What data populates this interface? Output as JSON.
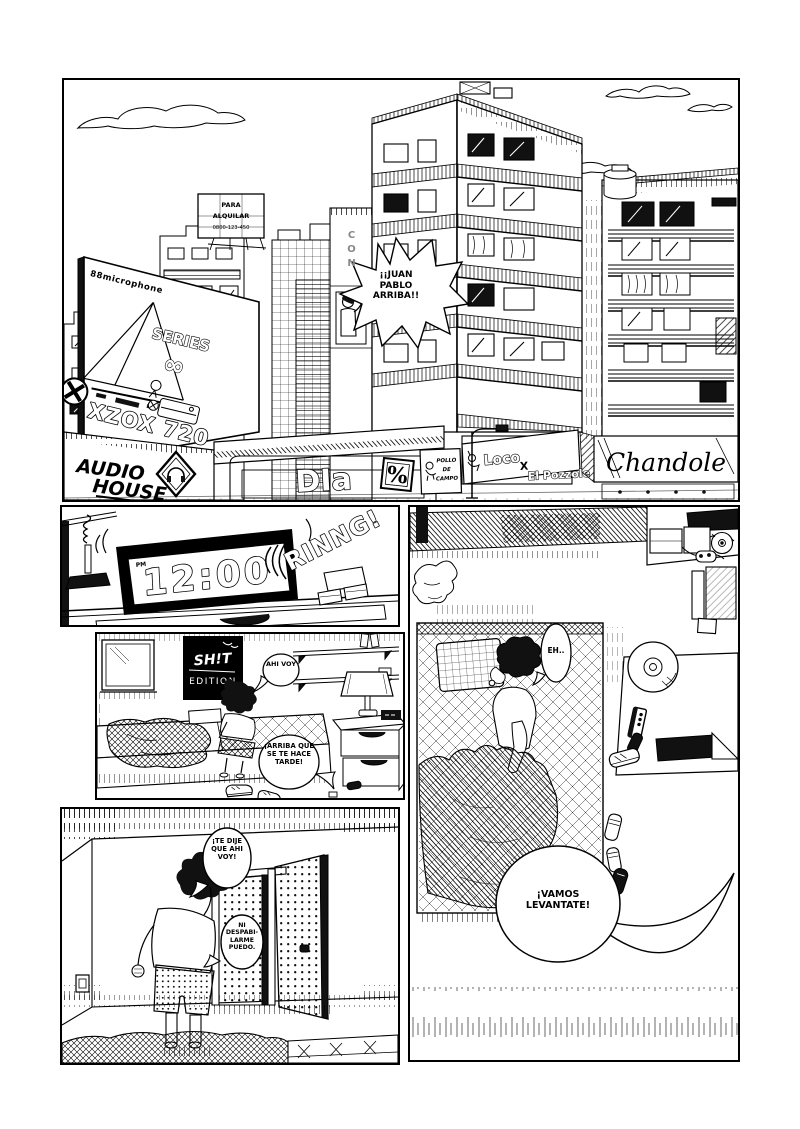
{
  "page": {
    "type": "comic-page",
    "bg": "#ffffff",
    "ink": "#000000"
  },
  "panel_city": {
    "speech_shout": "¡¡JUAN PABLO ARRIBA!!",
    "billboard": {
      "brand": "88microphone",
      "series": "SERIES",
      "series_symbol": "∞",
      "model": "XZOX 720"
    },
    "signs": {
      "rent_line1": "PARA",
      "rent_line2": "ALQUILAR",
      "rent_line3": "0800-123-450",
      "audio_line1": "AUDIO",
      "audio_line2": "HOUSE",
      "dia": "DIa",
      "dia_mark": "%",
      "pollo_line1": "POLLO",
      "pollo_line2": "DE",
      "pollo_line3": "CAMPO",
      "loco": "Loco",
      "loco_sep": "X",
      "pozzole": "El Pozzole",
      "chandole": "Chandole",
      "vertical_sign": "CON"
    }
  },
  "panel_clock": {
    "meridiem": "PM",
    "time": "12:00",
    "sfx": "RINNG!"
  },
  "panel_bedroom": {
    "poster_line1": "SH!T",
    "poster_line2": "EDITION",
    "speech_boy": "AHI VOY",
    "speech_mom": "¡ARRIBA QUE SE TE HACE TARDE!"
  },
  "panel_door": {
    "speech_boy": "¡TE DIJE QUE AHI VOY!",
    "speech_boy2": "NI DESPABI- LARME PUEDO."
  },
  "panel_overhead": {
    "speech_boy": "EH..",
    "speech_mom": "¡VAMOS LEVANTATE!"
  }
}
